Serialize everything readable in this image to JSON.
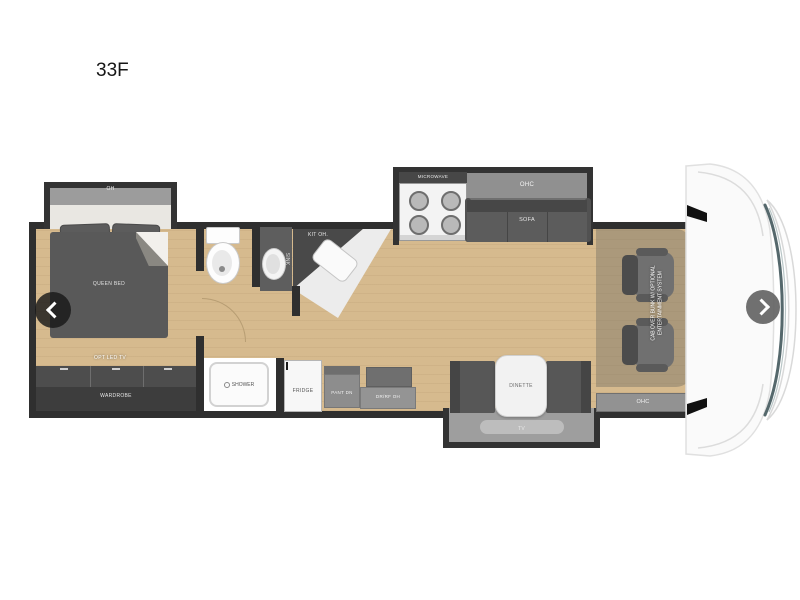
{
  "header": {
    "model": "33F"
  },
  "nav": {
    "prev_icon": "chevron-left",
    "next_icon": "chevron-right"
  },
  "colors": {
    "wall": "#2f2f2f",
    "slide_border": "#333333",
    "floor": "#d6ba8e",
    "furniture_dark": "#575757",
    "cabinet_gray": "#8f8f8f",
    "fixture_white": "#f7f7f7"
  },
  "bedroom": {
    "slide_overhead": "OH",
    "bed": "QUEEN BED",
    "tv": "OPT LED TV",
    "wardrobe": "WARDROBE"
  },
  "bath": {
    "sink": "SINK",
    "shower": "SHOWER"
  },
  "kitchen": {
    "overhead": "KIT OH.",
    "microwave": "MICROWAVE",
    "fridge": "FRIDGE",
    "pantry": "PANT DN",
    "entry_cabinet": "DR/RF OH",
    "overhead_cabinet": "OHC"
  },
  "living": {
    "sofa": "SOFA",
    "dinette": "DINETTE",
    "tv": "TV",
    "rear_overhead": "OHC"
  },
  "cab": {
    "bunk_note_line1": "CAB OVER BUNK W/ OPTIONAL",
    "bunk_note_line2": "ENTERTAINMENT SYSTEM"
  }
}
